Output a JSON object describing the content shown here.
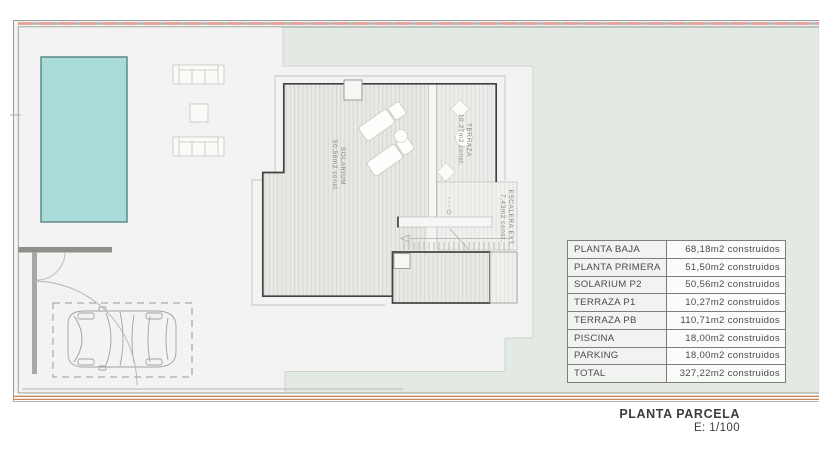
{
  "drawing": {
    "labels": {
      "solarium": {
        "name": "SOLARIUM",
        "area": "50,56m2 const."
      },
      "terraza": {
        "name": "TERRAZA",
        "area": "10,27m2 const."
      },
      "escalera": {
        "name": "ESCALERA EXT.",
        "area": "7,43m2 const."
      }
    }
  },
  "areas_table": {
    "rows": [
      {
        "label": "PLANTA BAJA",
        "value": "68,18m2 construidos"
      },
      {
        "label": "PLANTA PRIMERA",
        "value": "51,50m2 construidos"
      },
      {
        "label": "SOLARIUM P2",
        "value": "50,56m2 construidos"
      },
      {
        "label": "TERRAZA P1",
        "value": "10,27m2 construidos"
      },
      {
        "label": "TERRAZA PB",
        "value": "110,71m2 construidos"
      },
      {
        "label": "PISCINA",
        "value": "18,00m2 construidos"
      },
      {
        "label": "PARKING",
        "value": "18,00m2 construidos"
      },
      {
        "label": "TOTAL",
        "value": "327,22m2 construidos"
      }
    ]
  },
  "title_block": {
    "title": "PLANTA PARCELA",
    "scale": "E: 1/100"
  },
  "colors": {
    "pool": "#a9dbd9",
    "garden": "#e3eae4",
    "boundary_red": "#e69b93",
    "boundary_orange": "#c8875e",
    "walls": "#414141"
  }
}
